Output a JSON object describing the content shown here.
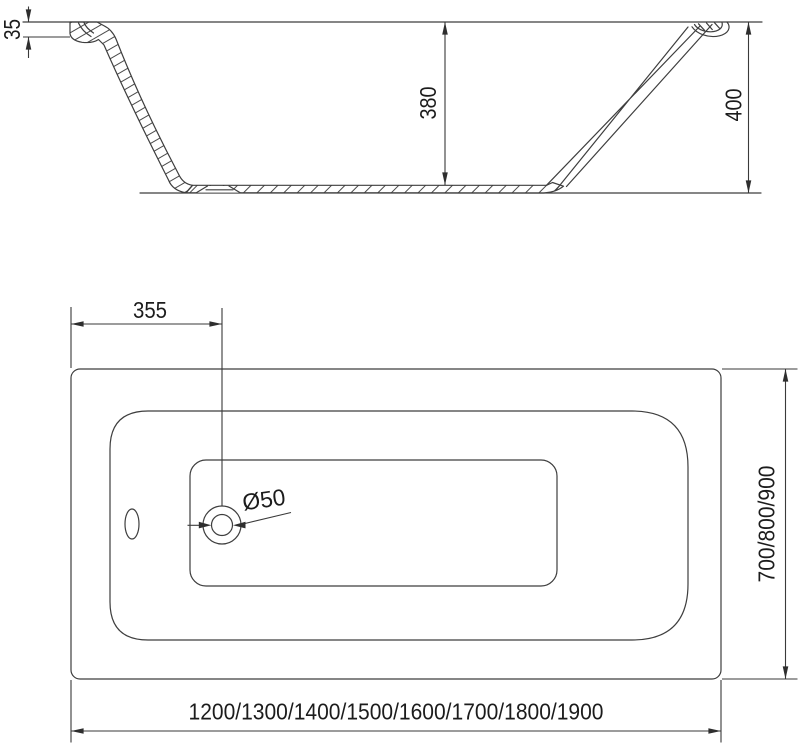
{
  "diagram": {
    "type": "technical-drawing",
    "subject": "bathtub",
    "side_view": {
      "rim_lip_height": "35",
      "inner_depth": "380",
      "overall_height": "400"
    },
    "plan_view": {
      "drain_offset_from_edge": "355",
      "drain_diameter": "Ø50",
      "width_options": "700/800/900",
      "length_options": "1200/1300/1400/1500/1600/1700/1800/1900"
    },
    "colors": {
      "line": "#3e3e3e",
      "text": "#1c1c1c",
      "background": "#ffffff"
    }
  }
}
